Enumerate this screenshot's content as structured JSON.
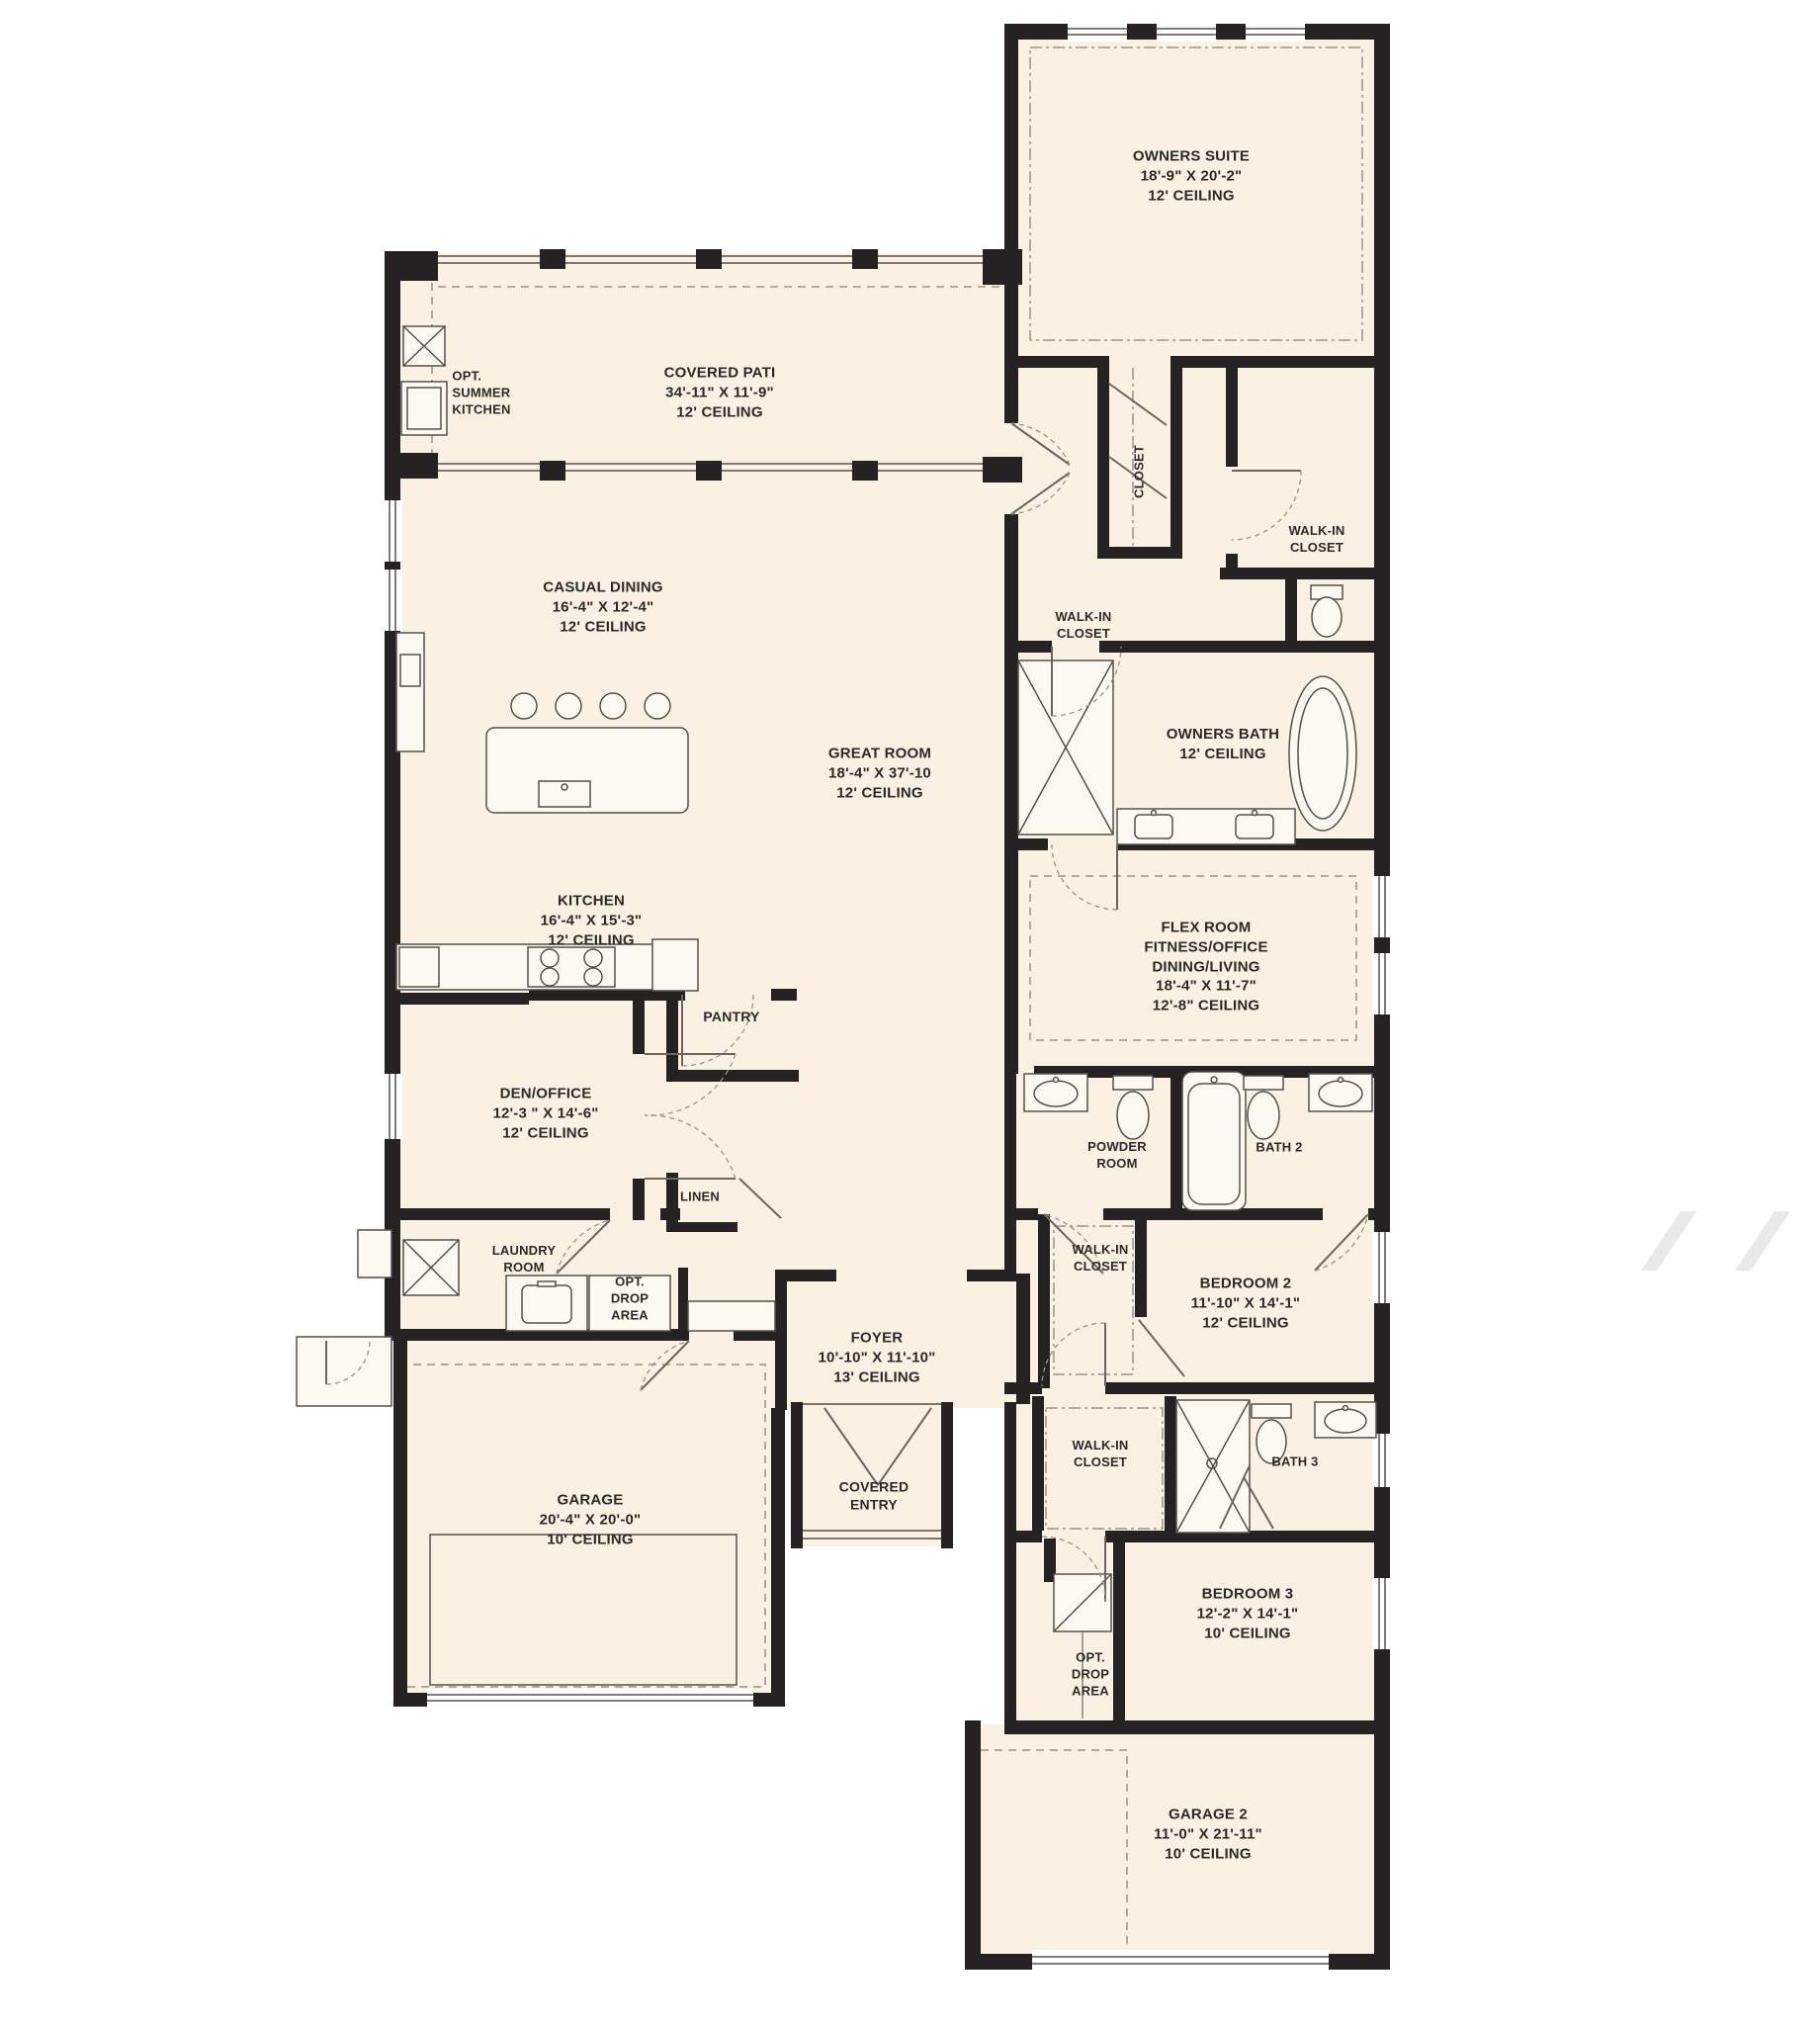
{
  "palette": {
    "background": "#FFFFFF",
    "floor": "#FBF1E3",
    "wall": "#262223",
    "thin_line": "#55504d",
    "dashed_line": "#9a9287",
    "text": "#2D2928",
    "watermark": "#E9E9E9"
  },
  "rooms": [
    {
      "id": "owners-suite",
      "lines": [
        "OWNERS SUITE",
        "18'-9\" X 20'-2\"",
        "12' CEILING"
      ]
    },
    {
      "id": "opt-summer-kitchen",
      "lines": [
        "OPT.",
        "SUMMER",
        "KITCHEN"
      ]
    },
    {
      "id": "covered-patio",
      "lines": [
        "COVERED PATI",
        "34'-11\" X 11'-9\"",
        "12' CEILING"
      ]
    },
    {
      "id": "casual-dining",
      "lines": [
        "CASUAL DINING",
        "16'-4\" X 12'-4\"",
        "12' CEILING"
      ]
    },
    {
      "id": "closet",
      "lines": [
        "CLOSET"
      ]
    },
    {
      "id": "walk-in-closet-owners-1",
      "lines": [
        "WALK-IN",
        "CLOSET"
      ]
    },
    {
      "id": "walk-in-closet-owners-2",
      "lines": [
        "WALK-IN",
        "CLOSET"
      ]
    },
    {
      "id": "owners-bath",
      "lines": [
        "OWNERS BATH",
        "12' CEILING"
      ]
    },
    {
      "id": "great-room",
      "lines": [
        "GREAT ROOM",
        "18'-4\" X 37'-10",
        "12' CEILING"
      ]
    },
    {
      "id": "flex-room",
      "lines": [
        "FLEX ROOM",
        "FITNESS/OFFICE",
        "DINING/LIVING",
        "18'-4\" X 11'-7\"",
        "12'-8\" CEILING"
      ]
    },
    {
      "id": "kitchen",
      "lines": [
        "KITCHEN",
        "16'-4\" X 15'-3\"",
        "12' CEILING"
      ]
    },
    {
      "id": "pantry",
      "lines": [
        "PANTRY"
      ]
    },
    {
      "id": "den-office",
      "lines": [
        "DEN/OFFICE",
        "12'-3 \" X 14'-6\"",
        "12' CEILING"
      ]
    },
    {
      "id": "powder-room",
      "lines": [
        "POWDER",
        "ROOM"
      ]
    },
    {
      "id": "bath-2",
      "lines": [
        "BATH 2"
      ]
    },
    {
      "id": "linen",
      "lines": [
        "LINEN"
      ]
    },
    {
      "id": "laundry-room",
      "lines": [
        "LAUNDRY",
        "ROOM"
      ]
    },
    {
      "id": "opt-drop-area-1",
      "lines": [
        "OPT.",
        "DROP",
        "AREA"
      ]
    },
    {
      "id": "foyer",
      "lines": [
        "FOYER",
        "10'-10\" X 11'-10\"",
        "13' CEILING"
      ]
    },
    {
      "id": "walk-in-closet-bedroom-2",
      "lines": [
        "WALK-IN",
        "CLOSET"
      ]
    },
    {
      "id": "bedroom-2",
      "lines": [
        "BEDROOM 2",
        "11'-10\" X 14'-1\"",
        "12' CEILING"
      ]
    },
    {
      "id": "garage",
      "lines": [
        "GARAGE",
        "20'-4\" X 20'-0\"",
        "10' CEILING"
      ]
    },
    {
      "id": "covered-entry",
      "lines": [
        "COVERED",
        "ENTRY"
      ]
    },
    {
      "id": "walk-in-closet-bedroom-3",
      "lines": [
        "WALK-IN",
        "CLOSET"
      ]
    },
    {
      "id": "bath-3",
      "lines": [
        "BATH 3"
      ]
    },
    {
      "id": "bedroom-3",
      "lines": [
        "BEDROOM 3",
        "12'-2\" X 14'-1\"",
        "10' CEILING"
      ]
    },
    {
      "id": "opt-drop-area-2",
      "lines": [
        "OPT.",
        "DROP",
        "AREA"
      ]
    },
    {
      "id": "garage-2",
      "lines": [
        "GARAGE 2",
        "11'-0\" X 21'-11\"",
        "10' CEILING"
      ]
    }
  ],
  "fixtures": [
    "summer-kitchen-sink",
    "summer-kitchen-grill",
    "kitchen-island",
    "bar-stools",
    "island-sink",
    "cooktop",
    "kitchen-sink",
    "refrigerator",
    "buffet-counter",
    "walk-in-shower",
    "soaking-tub",
    "double-vanity",
    "toilet",
    "bathtub",
    "powder-sink",
    "laundry-sink",
    "washer",
    "dryer",
    "drop-zone-bench",
    "drop-zone-cabinet"
  ]
}
